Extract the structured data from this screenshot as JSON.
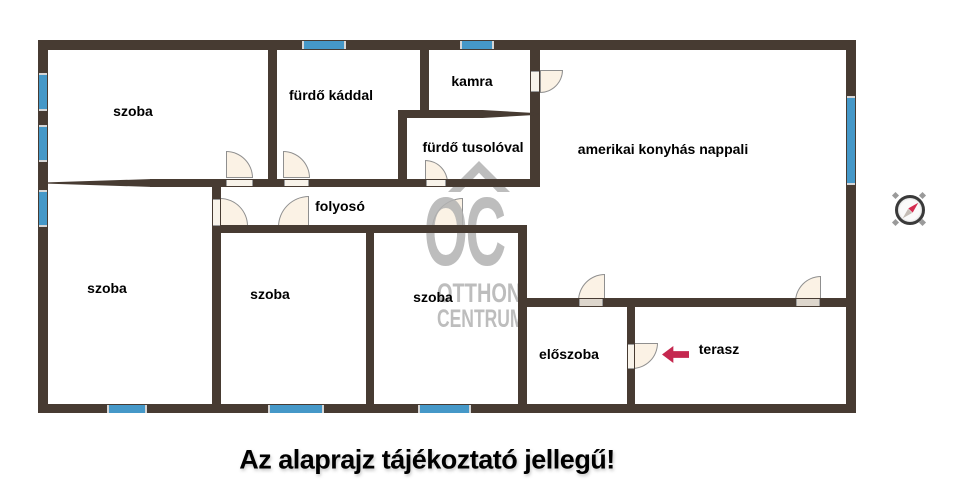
{
  "disclaimer": "Az alaprajz tájékoztató jellegű!",
  "watermark": {
    "oc": "OC",
    "otthon": "OTTHON",
    "centrum": "CENTRUM"
  },
  "colors": {
    "wall": "#473b32",
    "window": "#4598c8",
    "door_fill": "#fbf2e5",
    "door_stroke": "#8f8f8f",
    "watermark": "#b2b2b2",
    "entry_arrow": "#c5284f",
    "label_text": "#000000",
    "compass_needle": "#d42c50"
  },
  "rooms": [
    {
      "label": "szoba",
      "cx": 133,
      "cy": 111
    },
    {
      "label": "fürdő káddal",
      "cx": 331,
      "cy": 95
    },
    {
      "label": "kamra",
      "cx": 472,
      "cy": 81
    },
    {
      "label": "fürdő tusolóval",
      "cx": 473,
      "cy": 147
    },
    {
      "label": "amerikai konyhás nappali",
      "cx": 663,
      "cy": 149
    },
    {
      "label": "folyosó",
      "cx": 340,
      "cy": 206
    },
    {
      "label": "szoba",
      "cx": 107,
      "cy": 288
    },
    {
      "label": "szoba",
      "cx": 270,
      "cy": 294
    },
    {
      "label": "szoba",
      "cx": 433,
      "cy": 297
    },
    {
      "label": "előszoba",
      "cx": 569,
      "cy": 354
    },
    {
      "label": "terasz",
      "cx": 719,
      "cy": 349
    }
  ],
  "walls": [
    {
      "x": 40,
      "y": 40,
      "w": 816,
      "h": 10
    },
    {
      "x": 38,
      "y": 40,
      "w": 10,
      "h": 373
    },
    {
      "x": 38,
      "y": 404,
      "w": 818,
      "h": 9
    },
    {
      "x": 846,
      "y": 40,
      "w": 10,
      "h": 373
    },
    {
      "x": 268,
      "y": 40,
      "w": 9,
      "h": 147
    },
    {
      "x": 420,
      "y": 44,
      "w": 9,
      "h": 73
    },
    {
      "x": 530,
      "y": 44,
      "w": 10,
      "h": 142
    },
    {
      "x": 398,
      "y": 110,
      "w": 141,
      "h": 8,
      "taper": "right"
    },
    {
      "x": 398,
      "y": 114,
      "w": 9,
      "h": 73
    },
    {
      "x": 150,
      "y": 179,
      "w": 390,
      "h": 8
    },
    {
      "x": 47,
      "y": 179,
      "w": 106,
      "h": 8,
      "taper": "left"
    },
    {
      "x": 212,
      "y": 179,
      "w": 9,
      "h": 234
    },
    {
      "x": 212,
      "y": 225,
      "w": 315,
      "h": 8
    },
    {
      "x": 366,
      "y": 225,
      "w": 8,
      "h": 188
    },
    {
      "x": 518,
      "y": 225,
      "w": 9,
      "h": 188
    },
    {
      "x": 518,
      "y": 298,
      "w": 338,
      "h": 9
    },
    {
      "x": 627,
      "y": 298,
      "w": 8,
      "h": 115
    }
  ],
  "windows": [
    {
      "x": 39,
      "y": 73,
      "w": 8,
      "h": 34,
      "o": "v"
    },
    {
      "x": 39,
      "y": 125,
      "w": 8,
      "h": 33,
      "o": "v"
    },
    {
      "x": 39,
      "y": 190,
      "w": 8,
      "h": 33,
      "o": "v"
    },
    {
      "x": 302,
      "y": 41,
      "w": 40,
      "h": 8,
      "o": "h"
    },
    {
      "x": 460,
      "y": 41,
      "w": 30,
      "h": 8,
      "o": "h"
    },
    {
      "x": 847,
      "y": 96,
      "w": 8,
      "h": 85,
      "o": "v"
    },
    {
      "x": 107,
      "y": 405,
      "w": 36,
      "h": 8,
      "o": "h"
    },
    {
      "x": 268,
      "y": 405,
      "w": 52,
      "h": 8,
      "o": "h"
    },
    {
      "x": 418,
      "y": 405,
      "w": 49,
      "h": 8,
      "o": "h"
    }
  ],
  "doors": [
    {
      "x": 226,
      "y": 151,
      "s": 27,
      "c": "tr"
    },
    {
      "x": 283,
      "y": 151,
      "s": 27,
      "c": "tr"
    },
    {
      "x": 425,
      "y": 160,
      "s": 23,
      "c": "tr"
    },
    {
      "x": 540,
      "y": 70,
      "s": 23,
      "c": "br"
    },
    {
      "x": 220,
      "y": 198,
      "s": 28,
      "c": "tr"
    },
    {
      "x": 278,
      "y": 196,
      "s": 31,
      "c": "tl"
    },
    {
      "x": 432,
      "y": 198,
      "s": 31,
      "c": "tl"
    },
    {
      "x": 578,
      "y": 274,
      "s": 27,
      "c": "tl"
    },
    {
      "x": 795,
      "y": 276,
      "s": 26,
      "c": "tl"
    },
    {
      "x": 632,
      "y": 343,
      "s": 26,
      "c": "br"
    }
  ],
  "thresholds": [
    {
      "x": 226,
      "y": 180,
      "w": 27,
      "h": 6,
      "o": "h"
    },
    {
      "x": 284,
      "y": 180,
      "w": 25,
      "h": 6,
      "o": "h"
    },
    {
      "x": 426,
      "y": 180,
      "w": 20,
      "h": 6,
      "o": "h"
    },
    {
      "x": 531,
      "y": 71,
      "w": 8,
      "h": 21,
      "o": "v"
    },
    {
      "x": 213,
      "y": 199,
      "w": 7,
      "h": 27,
      "o": "v"
    },
    {
      "x": 579,
      "y": 299,
      "w": 24,
      "h": 7,
      "o": "h",
      "shade": "dark"
    },
    {
      "x": 796,
      "y": 299,
      "w": 24,
      "h": 7,
      "o": "h",
      "shade": "dark"
    },
    {
      "x": 628,
      "y": 344,
      "w": 6,
      "h": 25,
      "o": "v"
    }
  ],
  "compass": {
    "direction": "up-right",
    "direction_deg": 45
  }
}
